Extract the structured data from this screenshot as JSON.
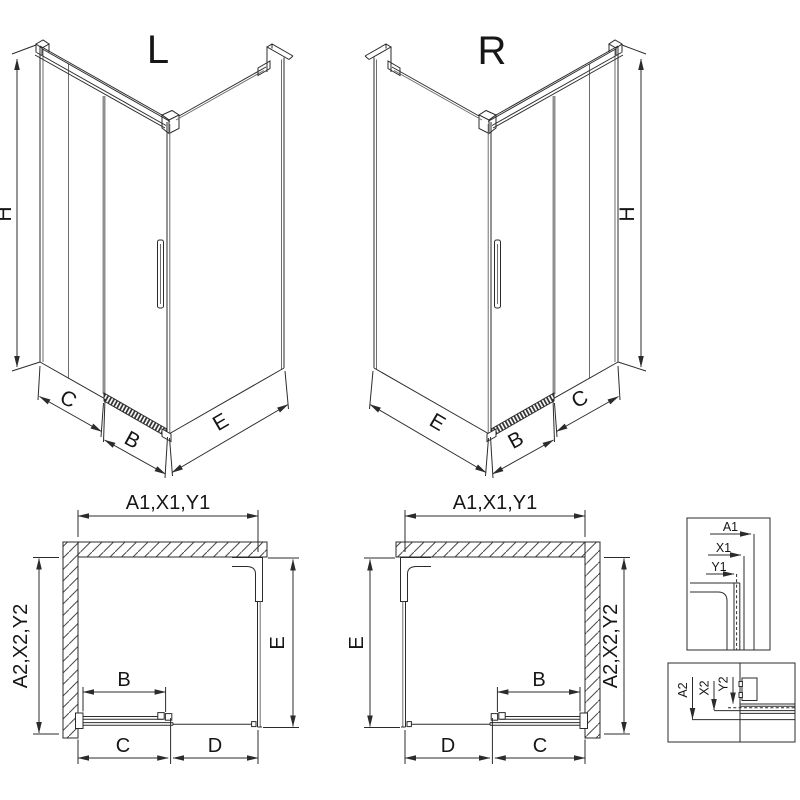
{
  "page": {
    "background": "#ffffff",
    "line_color": "#2b2b2b",
    "glass_strip_color": "#8f8f8f"
  },
  "views": {
    "iso_left": {
      "title": "L",
      "dims": {
        "h": "H",
        "c": "C",
        "b": "B",
        "e": "E"
      }
    },
    "iso_right": {
      "title": "R",
      "dims": {
        "h": "H",
        "c": "C",
        "b": "B",
        "e": "E"
      }
    },
    "plan_left": {
      "top": "A1,X1,Y1",
      "side": "A2,X2,Y2",
      "e": "E",
      "b": "B",
      "c": "C",
      "d": "D"
    },
    "plan_right": {
      "top": "A1,X1,Y1",
      "side": "A2,X2,Y2",
      "e": "E",
      "b": "B",
      "c": "C",
      "d": "D"
    },
    "detail_wall_profile": {
      "a1": "A1",
      "x1": "X1",
      "y1": "Y1"
    },
    "detail_floor_rail": {
      "a2": "A2",
      "x2": "X2",
      "y2": "Y2"
    }
  }
}
